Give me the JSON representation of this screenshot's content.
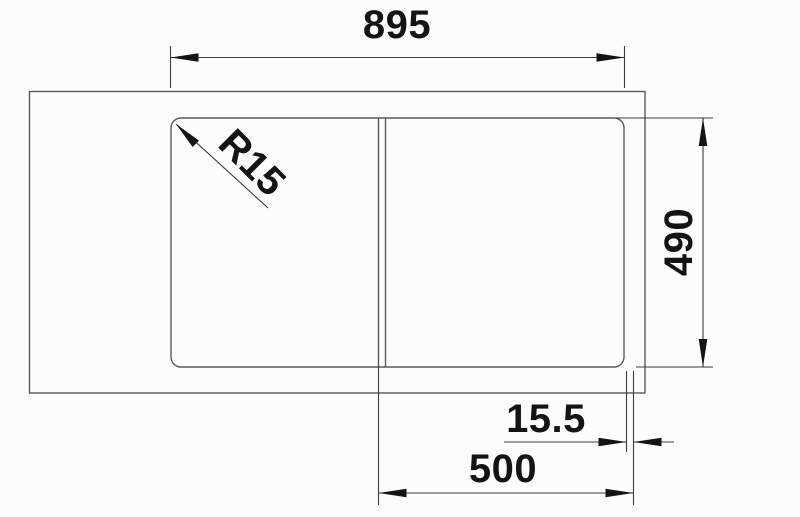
{
  "drawing": {
    "kind": "sink-installation-dimension-drawing",
    "colors": {
      "background": "#fcfcfc",
      "outline": "#5a5a5a",
      "dimension": "#3c3c3c",
      "text": "#141414"
    },
    "labels": {
      "top_width": "895",
      "corner_radius": "R15",
      "right_depth": "490",
      "offset_width": "15.5",
      "bowl_width": "500"
    }
  }
}
